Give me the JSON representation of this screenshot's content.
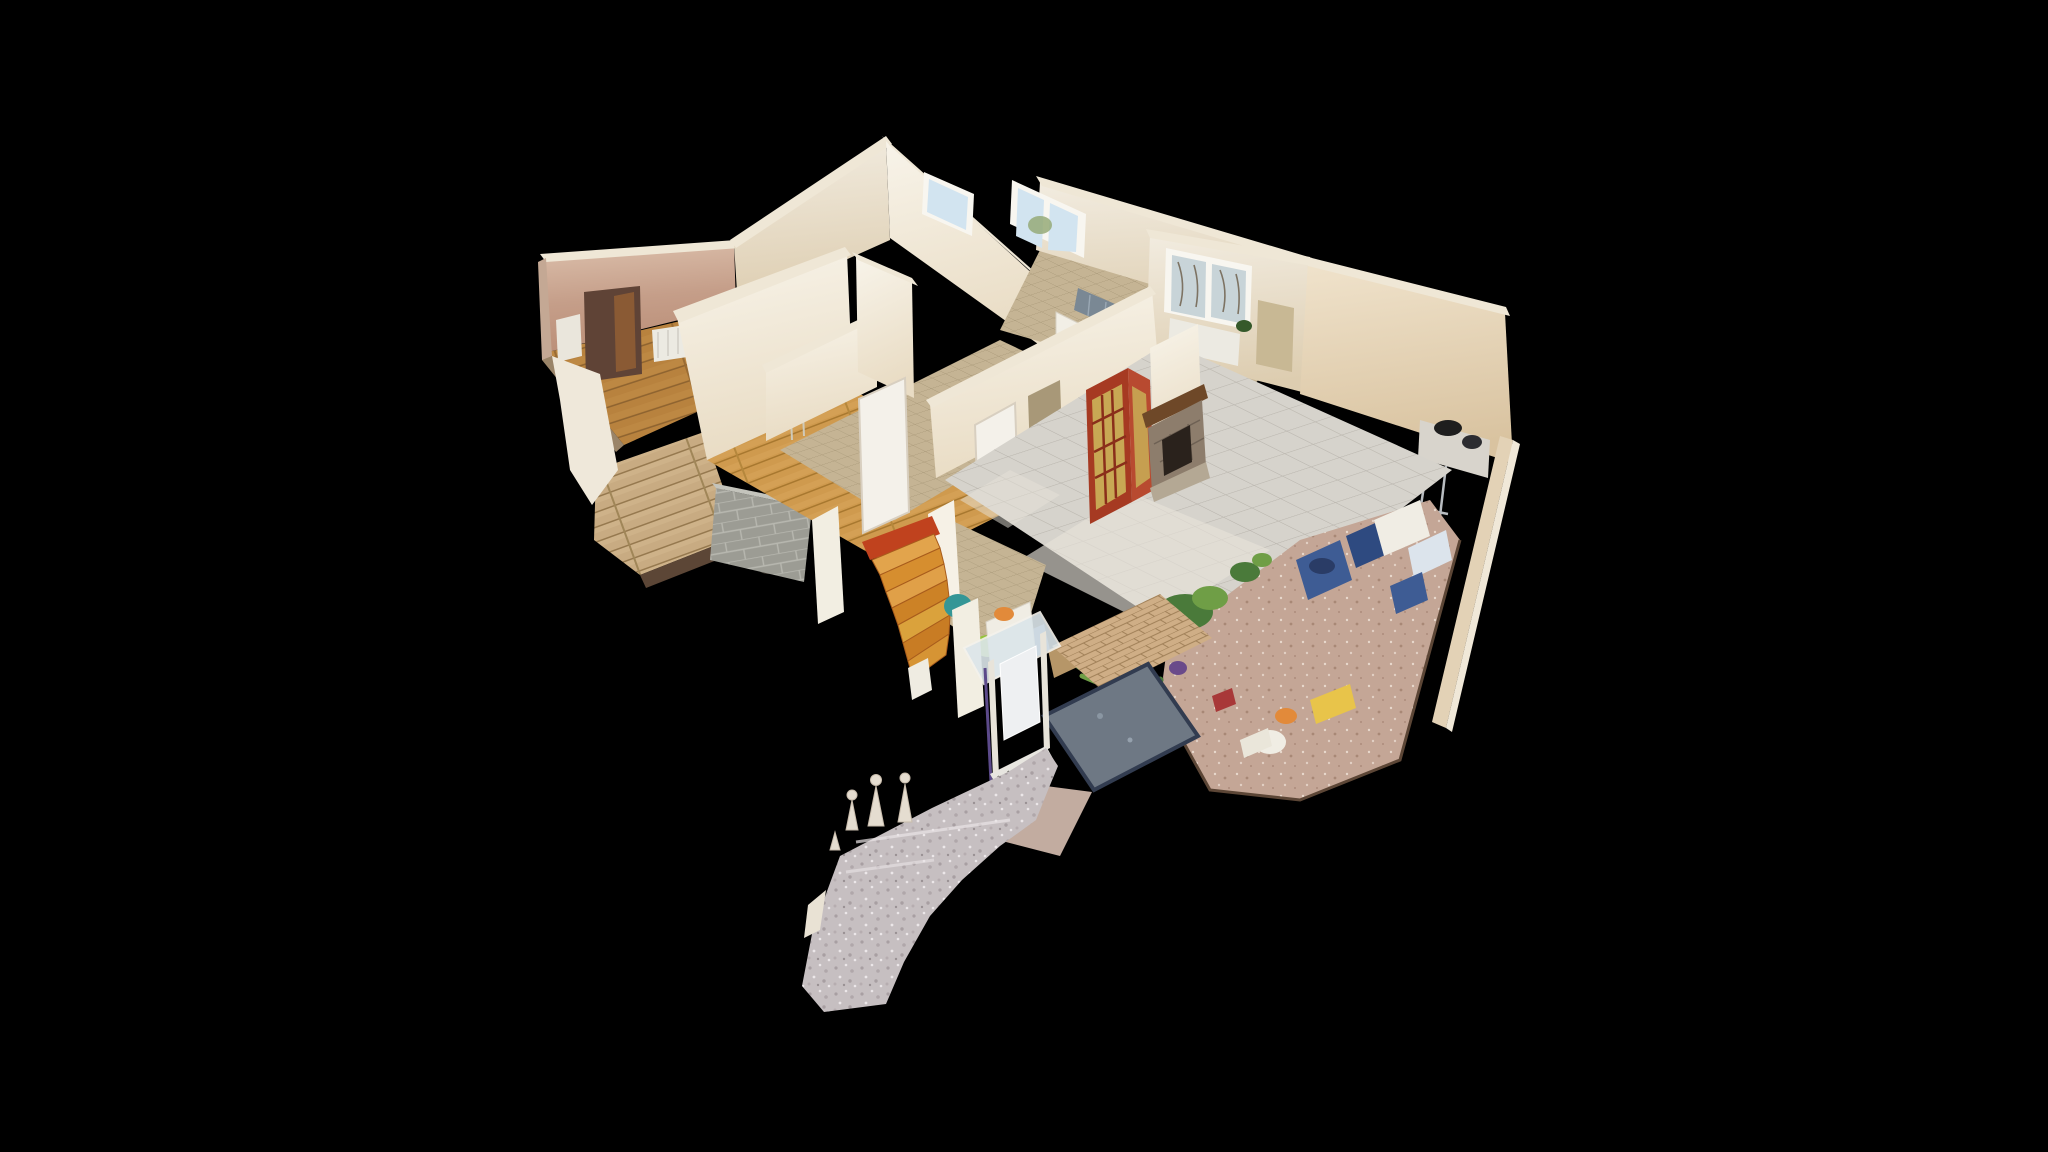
{
  "app": {
    "name": "3D home tour viewer",
    "view_mode": "dollhouse",
    "background_color": "#000000",
    "canvas_hint": "drag to orbit model"
  },
  "scene": {
    "description": "Cut-away dollhouse view of a scanned single-storey house interior seen from above on a black void",
    "rooms": [
      "pink bedroom",
      "middle bedroom",
      "kitchen",
      "hallway",
      "living room",
      "entry",
      "winder staircase",
      "veranda",
      "terrace",
      "front path"
    ],
    "colors": {
      "background": "#000000",
      "wall_top": "#efe7d6",
      "wall_bright": "#f6f1e6",
      "wall_cream": "#e9ddc6",
      "wall_pink_edge": "#c4a894",
      "floor_terracotta": "#c4a696",
      "stair_red": "#c0421e",
      "door_red": "#a63a22",
      "door_glass_amber": "#c8a854",
      "door_white": "#f4f1ea",
      "door_brown": "#8a5a34",
      "doorway_dark": "#5f4336",
      "fireplace_stone": "#8d7d6c",
      "fireplace_mantel": "#6e4828",
      "firebox_dark": "#2a221c",
      "hearth_stone": "#b4a894",
      "counter_blue": "#7a8894",
      "slate_hatch": "#6e7884",
      "slate_border": "#323c50",
      "grate_white": "#e8e6e0",
      "window_sky": "#d2e4f0",
      "window_tree": "#96aa78",
      "window_branch": "#6a5a46",
      "window_frame": "#f8f6f0",
      "plant_green": "#4a7a3a",
      "plant_light": "#6f9e46",
      "plant_dark": "#35592a",
      "clutter_blue": "#3e5c94",
      "clutter_navy": "#2e4a80",
      "clutter_teal": "#349696",
      "clutter_green_bag": "#96c43c",
      "clutter_orange": "#e28a3a",
      "clutter_yellow": "#e8c44a",
      "clutter_white": "#f0ede4",
      "clutter_cardboard": "#b69668",
      "clutter_purple": "#6a4a8a",
      "clutter_red": "#a83838",
      "radiator_white": "#eceae2",
      "appliance_white": "#eae6dc",
      "gnome_light": "#e5ddd0",
      "concrete_pink": "#c2aca0",
      "cut_edge_dark": "#5c4636",
      "desk_black": "#1e1e1e",
      "newel_white": "#efece2",
      "porch_glass": "#dce6ea",
      "porch_post": "#e8e4da",
      "porch_purple_edge": "#5c4a8a"
    }
  }
}
